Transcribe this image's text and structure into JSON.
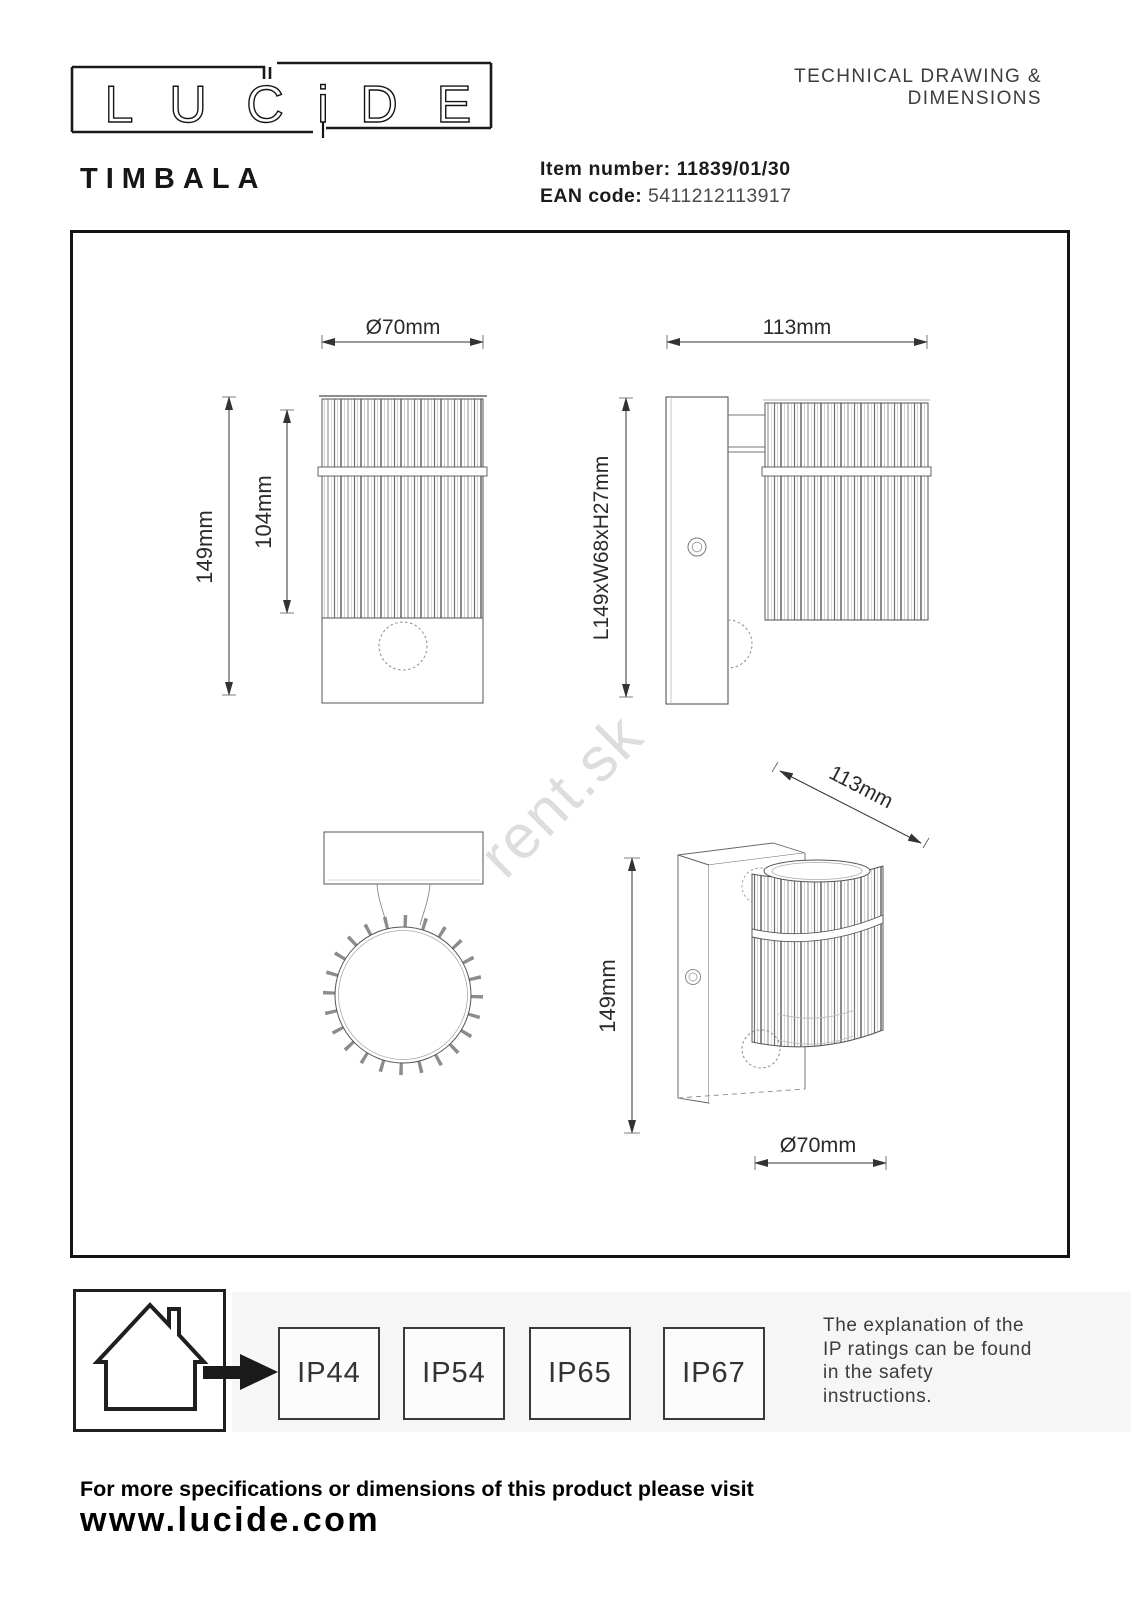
{
  "colors": {
    "ink": "#1a1a1a",
    "frame": "#141414",
    "band_bg": "#f6f6f6",
    "watermark": "#000000",
    "note_text": "#3c3c3c"
  },
  "logo": {
    "text": "LUCiDE",
    "chars": [
      "L",
      "U",
      "C",
      "i",
      "D",
      "E"
    ]
  },
  "header": {
    "doc_type": "TECHNICAL DRAWING & DIMENSIONS"
  },
  "product": {
    "name": "TIMBALA",
    "item_label": "Item number:",
    "item_value": "11839/01/30",
    "ean_label": "EAN code:",
    "ean_value": "5411212113917"
  },
  "watermark": {
    "text": "rent.sk"
  },
  "drawings": {
    "front": {
      "diameter": "Ø70mm",
      "height": "149mm",
      "body_height": "104mm"
    },
    "side": {
      "width": "113mm",
      "dimensions": "L149xW68xH27mm"
    },
    "perspective": {
      "width": "113mm",
      "height": "149mm",
      "diameter": "Ø70mm"
    }
  },
  "ip": {
    "ratings": [
      "IP44",
      "IP54",
      "IP65",
      "IP67"
    ],
    "note_lines": [
      "The explanation of the",
      "IP ratings can be found",
      "in the safety",
      "instructions."
    ]
  },
  "footer": {
    "line1": "For more specifications or dimensions of this product please visit",
    "line2": "www.lucide.com"
  }
}
